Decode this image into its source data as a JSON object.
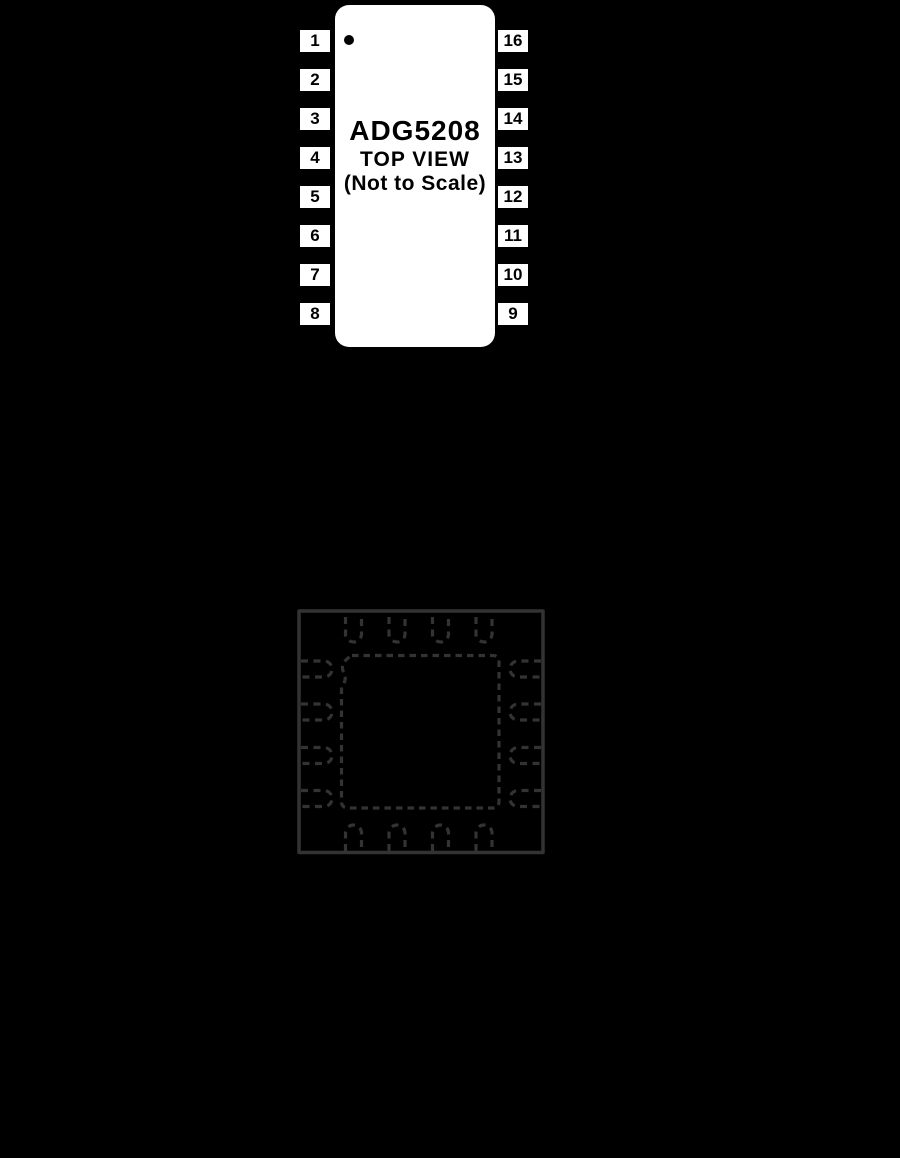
{
  "page": {
    "background_color": "#000000"
  },
  "tssop_diagram": {
    "package": "16-lead pin configuration, top view",
    "title": "ADG5208",
    "subtitle": "TOP VIEW",
    "subtitle2": "(Not to Scale)",
    "body_color": "#ffffff",
    "text_color": "#000000",
    "pin1_indicator": "dot",
    "left_pins": [
      "1",
      "2",
      "3",
      "4",
      "5",
      "6",
      "7",
      "8"
    ],
    "right_pins": [
      "16",
      "15",
      "14",
      "13",
      "12",
      "11",
      "10",
      "9"
    ]
  },
  "lfcsp_diagram": {
    "package": "16-lead LFCSP outline, dashed leads with exposed pad",
    "outline_color": "#333333",
    "pins_per_side": 4,
    "total_pins": 16,
    "exposed_pad": "dashed square with chamfered pin-1 corner"
  }
}
